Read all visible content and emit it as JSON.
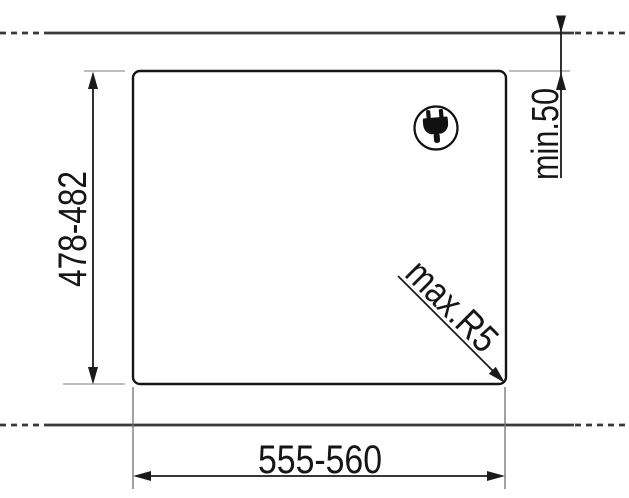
{
  "diagram": {
    "description": "Built-in hob worktop cutout installation drawing",
    "labels": {
      "cutout_height": "478-482",
      "cutout_width": "555-560",
      "rear_clearance": "min.50",
      "corner_radius": "max.R5"
    },
    "icons": {
      "plug": "power-plug-icon"
    },
    "colors": {
      "background": "#ffffff",
      "drawing_line": "#1a1a1a",
      "worktop_line": "#3a3a3a",
      "tick_line": "#a8a8a8",
      "extension_line": "#707070"
    }
  }
}
